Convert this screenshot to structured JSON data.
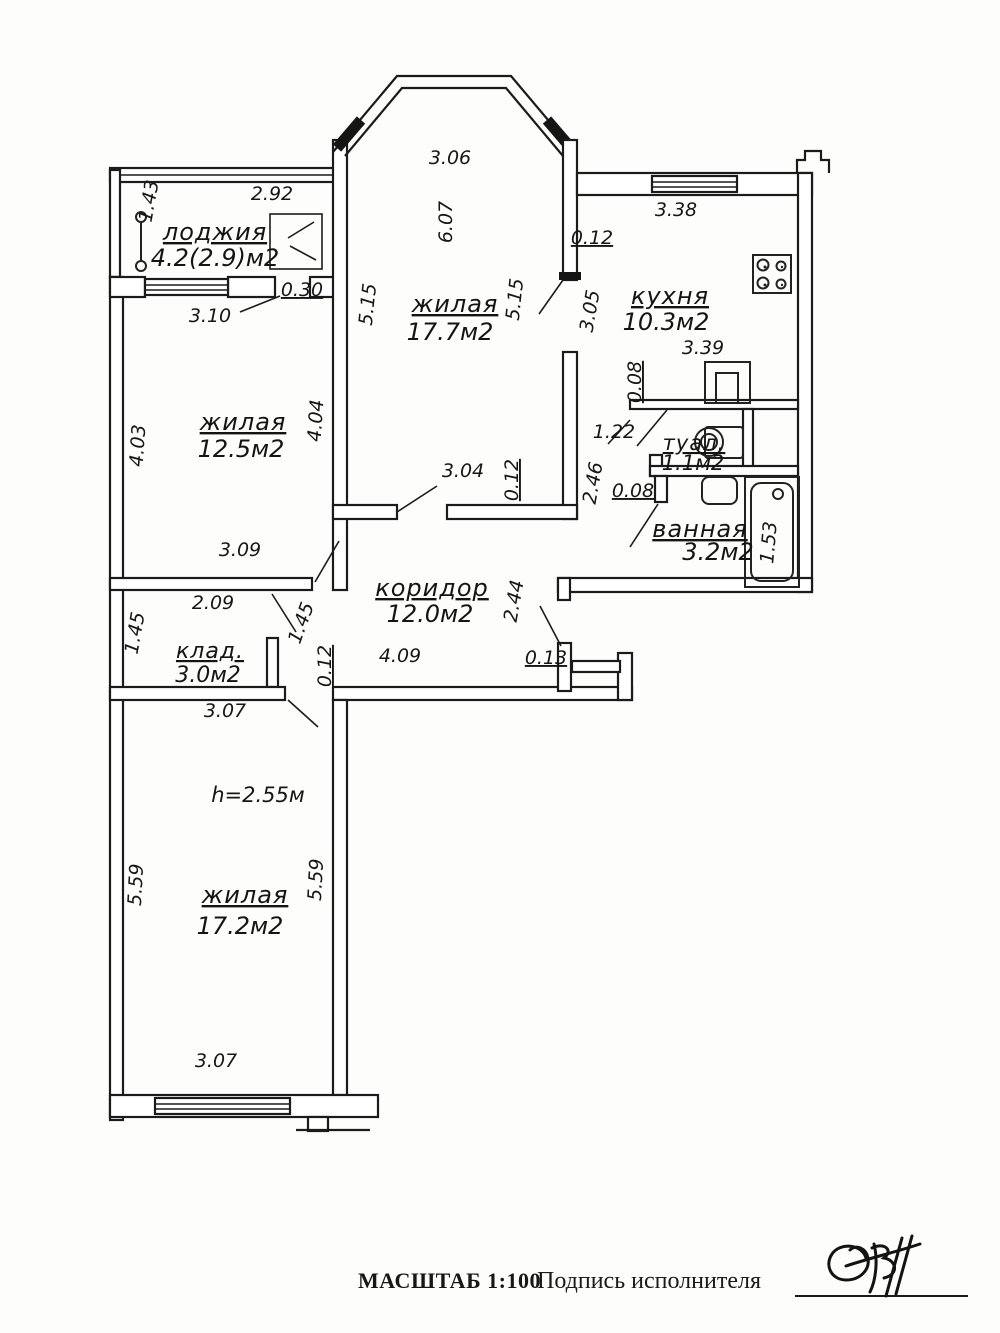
{
  "plan_title": "apartment floor plan",
  "rooms": {
    "loggia": {
      "name": "лоджия",
      "area": "4.2(2.9)м2"
    },
    "living_top": {
      "name": "жилая",
      "area": "17.7м2"
    },
    "kitchen": {
      "name": "кухня",
      "area": "10.3м2"
    },
    "living_left": {
      "name": "жилая",
      "area": "12.5м2"
    },
    "toilet": {
      "name": "туал.",
      "area": "1.1м2"
    },
    "bath": {
      "name": "ванная",
      "area": "3.2м2"
    },
    "corridor": {
      "name": "коридор",
      "area": "12.0м2"
    },
    "storage": {
      "name": "клад.",
      "area": "3.0м2"
    },
    "living_bottom": {
      "name": "жилая",
      "area": "17.2м2",
      "height": "h=2.55м"
    }
  },
  "dims": {
    "loggia_width": "2.92",
    "loggia_depth": "1.43",
    "balcony_door": "0.30",
    "room1_top": "3.06",
    "room1_height": "6.07",
    "room1_left": "5.15",
    "room1_right": "5.15",
    "room1_door": "3.04",
    "room1_wall": "0.12",
    "kitchen_top": "3.38",
    "kitchen_left": "3.05",
    "kitchen_width": "3.39",
    "kitchen_wall": "0.12",
    "kitchen_partition": "0.08",
    "toilet_entry": "1.22",
    "bath_height": "2.46",
    "bath_wall": "0.08",
    "bathtub_len": "1.53",
    "room2_left": "4.03",
    "room2_right": "4.04",
    "room2_bottom": "3.09",
    "room2_top": "3.10",
    "corridor_len": "4.09",
    "corridor_height": "2.44",
    "entry_stub": "0.13",
    "corridor_wall": "0.12",
    "storage_top": "2.09",
    "storage_left": "1.45",
    "storage_right": "1.45",
    "storage_bottom": "3.07",
    "room3_left": "5.59",
    "room3_right": "5.59",
    "room3_bottom": "3.07"
  },
  "footer": {
    "scale": "МАСШТАБ 1:100",
    "signature_label": "Подпись исполнителя"
  },
  "colors": {
    "ink": "#1b1b1b",
    "paper": "#fdfdfb"
  }
}
